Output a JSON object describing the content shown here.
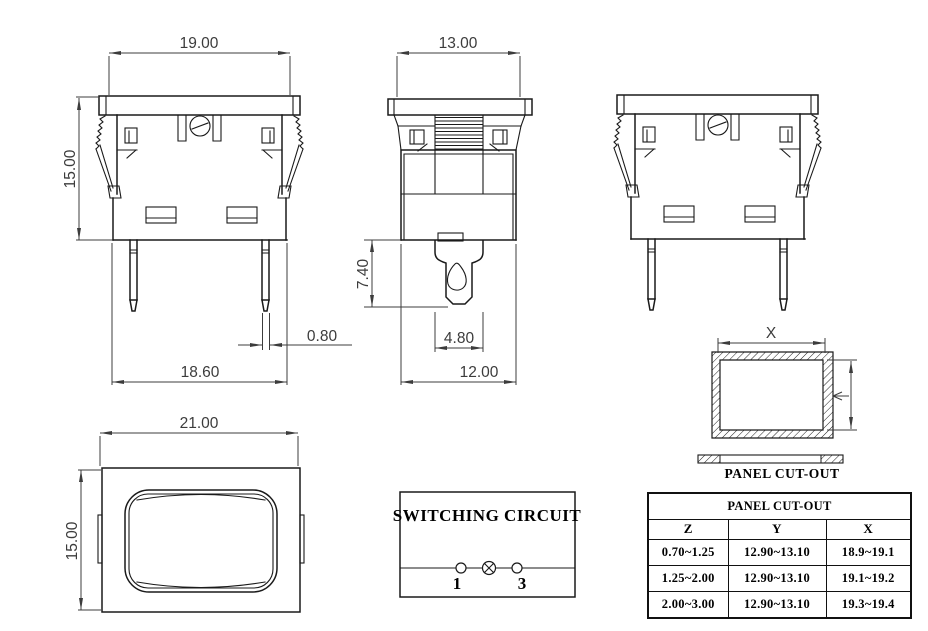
{
  "front": {
    "width_top": "19.00",
    "height": "15.00",
    "pin_width": "0.80",
    "width_bottom": "18.60"
  },
  "side": {
    "width_top": "13.00",
    "terminal_length": "7.40",
    "terminal_width": "4.80",
    "width_bottom": "12.00"
  },
  "face": {
    "width": "21.00",
    "height": "15.00"
  },
  "panel": {
    "x_label": "X",
    "caption": "PANEL CUT-OUT"
  },
  "circuit": {
    "title": "SWITCHING CIRCUIT",
    "terminal_1": "1",
    "terminal_3": "3"
  },
  "table": {
    "title": "PANEL CUT-OUT",
    "columns": [
      "Z",
      "Y",
      "X"
    ],
    "rows": [
      [
        "0.70~1.25",
        "12.90~13.10",
        "18.9~19.1"
      ],
      [
        "1.25~2.00",
        "12.90~13.10",
        "19.1~19.2"
      ],
      [
        "2.00~3.00",
        "12.90~13.10",
        "19.3~19.4"
      ]
    ]
  },
  "colors": {
    "line": "#1a1a1a",
    "dim": "#3c3c3c",
    "background": "#ffffff"
  }
}
